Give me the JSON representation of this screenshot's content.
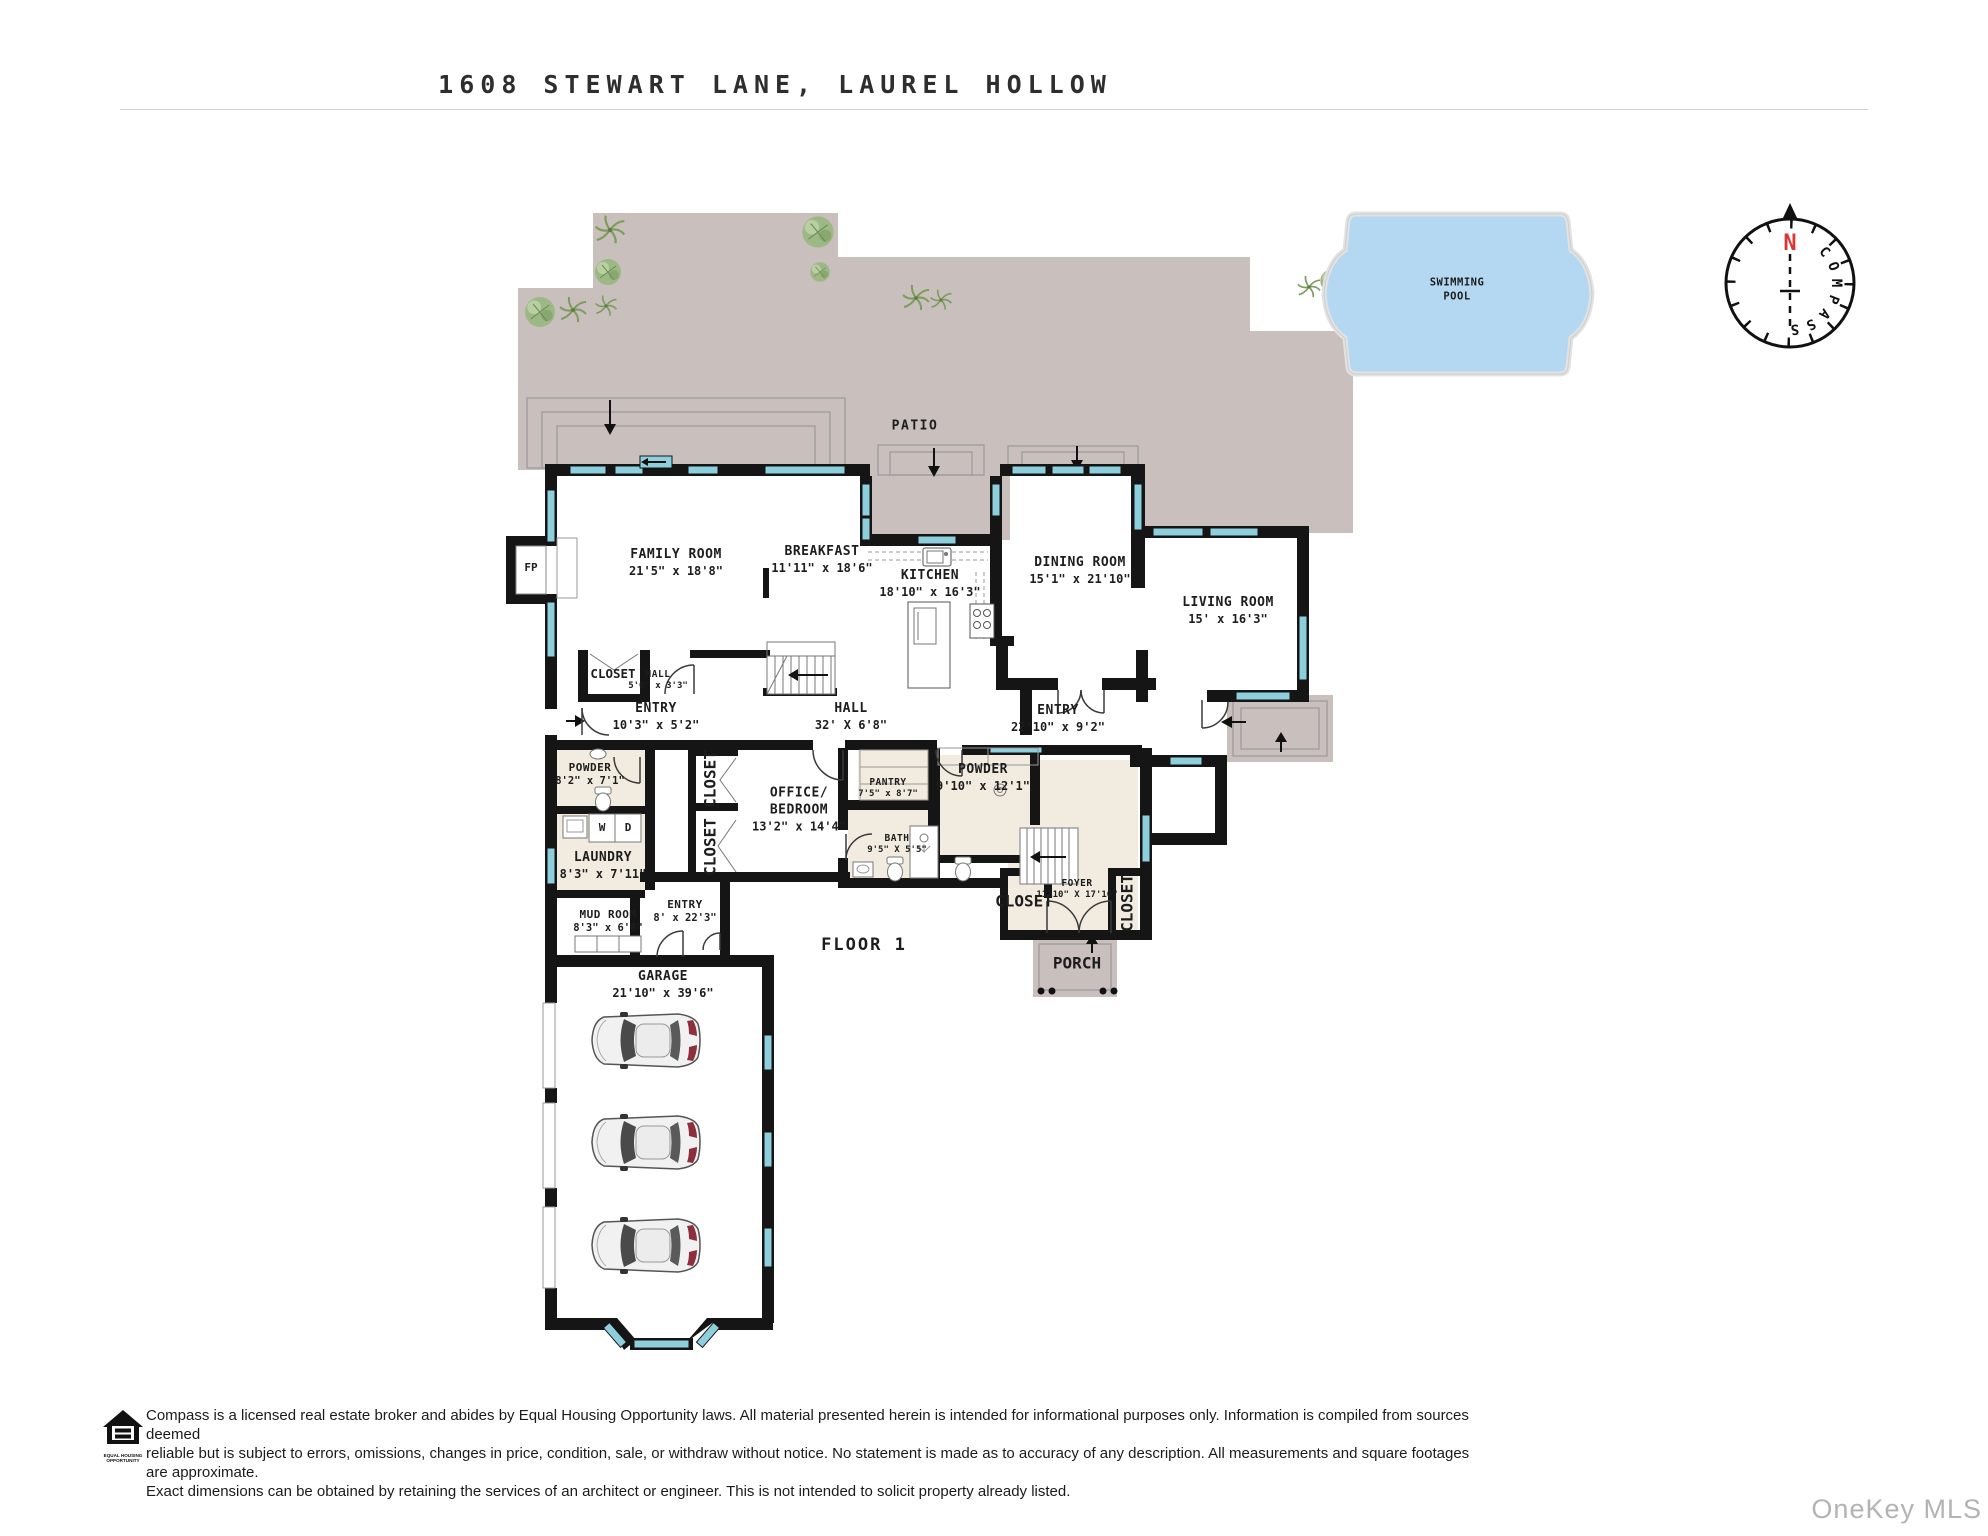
{
  "title": "1608 STEWART LANE, LAUREL HOLLOW",
  "labels": {
    "patio": {
      "name": "PATIO"
    },
    "family": {
      "name": "FAMILY ROOM",
      "dims": "21'5\" x 18'8\""
    },
    "breakfast": {
      "name": "BREAKFAST",
      "dims": "11'11\" x 18'6\""
    },
    "kitchen": {
      "name": "KITCHEN",
      "dims": "18'10\" x 16'3\""
    },
    "dining": {
      "name": "DINING ROOM",
      "dims": "15'1\" x 21'10\""
    },
    "living": {
      "name": "LIVING ROOM",
      "dims": "15' x 16'3\""
    },
    "hall_closet": {
      "name": "CLOSET"
    },
    "hall_small": {
      "name": "HALL",
      "dims": "5'0\" x 3'3\""
    },
    "entry_left": {
      "name": "ENTRY",
      "dims": "10'3\" x 5'2\""
    },
    "hall_main": {
      "name": "HALL",
      "dims": "32' X 6'8\""
    },
    "entry_right": {
      "name": "ENTRY",
      "dims": "22'10\" x 9'2\""
    },
    "powder_left": {
      "name": "POWDER",
      "dims": "8'2\" x 7'1\""
    },
    "laundry": {
      "name": "LAUNDRY",
      "dims": "8'3\" x 7'11\""
    },
    "washer": {
      "name": "W"
    },
    "dryer": {
      "name": "D"
    },
    "closet_office_upper": {
      "name": "CLOSET"
    },
    "closet_office_lower": {
      "name": "CLOSET"
    },
    "office": {
      "name": "OFFICE/",
      "name2": "BEDROOM",
      "dims": "13'2\" x 14'4\""
    },
    "pantry": {
      "name": "PANTRY",
      "dims": "7'5\" x 8'7\""
    },
    "powder_right": {
      "name": "POWDER",
      "dims": "9'10\"  x  12'1\""
    },
    "bath": {
      "name": "BATH",
      "dims": "9'5\" X 5'5\""
    },
    "mud": {
      "name": "MUD ROOM",
      "dims": "8'3\" x 6'8\""
    },
    "entry_garage": {
      "name": "ENTRY",
      "dims": "8' x 22'3\""
    },
    "garage": {
      "name": "GARAGE",
      "dims": "21'10\" x 39'6\""
    },
    "foyer": {
      "name": "FOYER",
      "dims": "11'10\" X 17'10\""
    },
    "closet_foyer": {
      "name": "CLOSET"
    },
    "closet_foyer_side": {
      "name": "CLOSET"
    },
    "porch": {
      "name": "PORCH"
    },
    "fireplace": {
      "name": "FP"
    },
    "floor": {
      "name": "FLOOR 1"
    },
    "pool": {
      "line1": "SWIMMING",
      "line2": "POOL"
    }
  },
  "compass": {
    "north": "N",
    "letters": [
      "C",
      "O",
      "M",
      "P",
      "A",
      "S",
      "S"
    ]
  },
  "footer": {
    "logo_line1": "EQUAL HOUSING",
    "logo_line2": "OPPORTUNITY",
    "disclaimer_lines": [
      "Compass is a licensed real estate broker and abides by Equal Housing Opportunity laws. All material presented herein is intended for informational purposes only. Information is compiled from sources deemed",
      "reliable but is subject to errors, omissions, changes in price, condition, sale, or withdraw without notice. No statement is made as to accuracy of any description. All measurements and square footages are approximate.",
      "Exact dimensions can be obtained by retaining the services of an architect or engineer. This is not intended to solicit property already listed."
    ]
  },
  "watermark": "OneKey MLS",
  "colors": {
    "wall": "#151515",
    "window": "#8ecfdd",
    "patio": "#c9bfbd",
    "pool": "#b4d8f1",
    "floor_tile": "#f1ecdf"
  }
}
